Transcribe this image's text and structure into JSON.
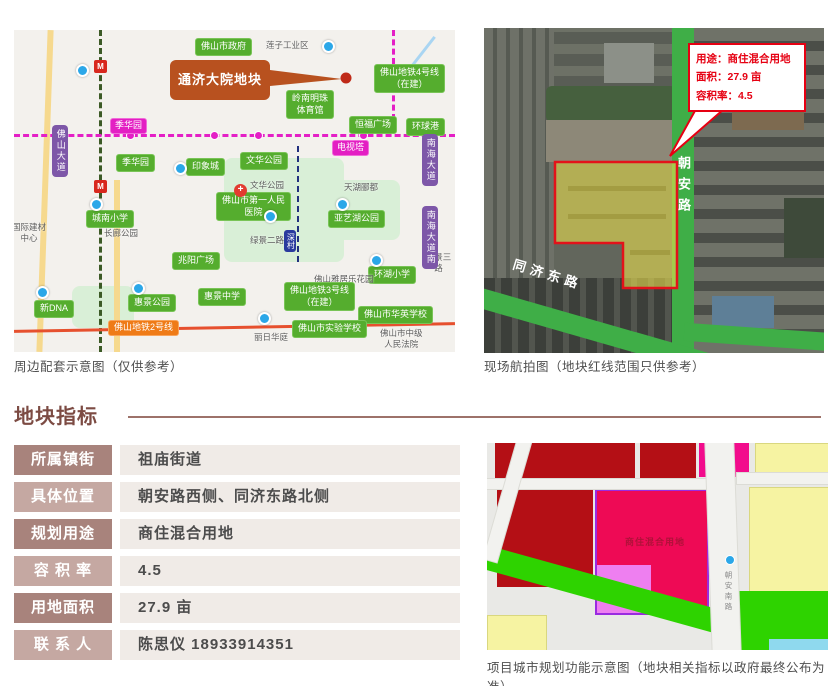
{
  "colors": {
    "section_accent": "#7c4b43",
    "table_label_dark": "#a8837c",
    "table_label_light": "#c5a8a2",
    "table_value_bg": "#f0ebe7",
    "annotation_red": "#e60012",
    "callout_orange": "#b8511f",
    "badge_green": "#55ad2e",
    "road_green": "#3fae47",
    "plan_dark_red": "#b40f15",
    "plan_crimson": "#ee0a55",
    "plan_magenta": "#f20c8c",
    "plan_yellow": "#f6f3a2",
    "plan_green": "#2ed300"
  },
  "map_panel": {
    "caption": "周边配套示意图（仅供参考）",
    "callout_label": "通济大院地块",
    "labels": [
      {
        "text": "佛山市政府",
        "type": "g",
        "x": 181,
        "y": 8
      },
      {
        "text": "莲子工业区",
        "type": "gt",
        "x": 252,
        "y": 10
      },
      {
        "text": "佛山地铁4号线\n（在建）",
        "type": "g",
        "x": 360,
        "y": 34
      },
      {
        "text": "岭南明珠\n体育馆",
        "type": "g",
        "x": 272,
        "y": 60
      },
      {
        "text": "恒福广场",
        "type": "g",
        "x": 335,
        "y": 86
      },
      {
        "text": "环球港",
        "type": "g",
        "x": 392,
        "y": 88
      },
      {
        "text": "季华园",
        "type": "m",
        "x": 96,
        "y": 88
      },
      {
        "text": "电视塔",
        "type": "m",
        "x": 318,
        "y": 110
      },
      {
        "text": "季华园",
        "type": "g",
        "x": 102,
        "y": 124
      },
      {
        "text": "印象城",
        "type": "g",
        "x": 172,
        "y": 128
      },
      {
        "text": "文华公园",
        "type": "g",
        "x": 226,
        "y": 122
      },
      {
        "text": "文华公园",
        "type": "gt",
        "x": 236,
        "y": 150
      },
      {
        "text": "天湖郦都",
        "type": "gt",
        "x": 330,
        "y": 152
      },
      {
        "text": "城南小学",
        "type": "g",
        "x": 72,
        "y": 180
      },
      {
        "text": "长廊公园",
        "type": "gt",
        "x": 90,
        "y": 198
      },
      {
        "text": "佛山市第一人民\n医院",
        "type": "g",
        "x": 202,
        "y": 162
      },
      {
        "text": "亚艺湖公园",
        "type": "g",
        "x": 314,
        "y": 180
      },
      {
        "text": "绿景二路",
        "type": "gt",
        "x": 236,
        "y": 205
      },
      {
        "text": "绿景三路",
        "type": "gt",
        "x": 408,
        "y": 222
      },
      {
        "text": "兆阳广场",
        "type": "g",
        "x": 158,
        "y": 222
      },
      {
        "text": "深村",
        "type": "bv",
        "x": 270,
        "y": 200
      },
      {
        "text": "环湖小学",
        "type": "g",
        "x": 354,
        "y": 236
      },
      {
        "text": "佛山雅居乐花园",
        "type": "gt",
        "x": 300,
        "y": 244
      },
      {
        "text": "佛山地铁3号线\n（在建）",
        "type": "g",
        "x": 270,
        "y": 252
      },
      {
        "text": "惠景中学",
        "type": "g",
        "x": 184,
        "y": 258
      },
      {
        "text": "惠景公园",
        "type": "g",
        "x": 114,
        "y": 264
      },
      {
        "text": "新DNA",
        "type": "g",
        "x": 20,
        "y": 270
      },
      {
        "text": "佛山市华英学校",
        "type": "g",
        "x": 344,
        "y": 276
      },
      {
        "text": "佛山市实验学校",
        "type": "g",
        "x": 278,
        "y": 290
      },
      {
        "text": "佛山地铁2号线",
        "type": "o",
        "x": 94,
        "y": 290
      },
      {
        "text": "丽日华庭",
        "type": "gt",
        "x": 240,
        "y": 302
      },
      {
        "text": "佛山市中级\n人民法院",
        "type": "gt",
        "x": 366,
        "y": 298
      },
      {
        "text": "国际建材\n中心",
        "type": "gt",
        "x": -2,
        "y": 192
      },
      {
        "text": "佛山大道",
        "type": "pv",
        "x": 38,
        "y": 95
      },
      {
        "text": "南海大道",
        "type": "pv",
        "x": 408,
        "y": 104
      },
      {
        "text": "南海大道南",
        "type": "pv",
        "x": 408,
        "y": 176
      },
      {
        "text": "M",
        "type": "micon",
        "x": 80,
        "y": 30
      },
      {
        "text": "M",
        "type": "micon",
        "x": 80,
        "y": 150
      },
      {
        "text": "+",
        "type": "hicon",
        "x": 220,
        "y": 154
      },
      {
        "text": "",
        "type": "marker",
        "x": 308,
        "y": 10
      },
      {
        "text": "",
        "type": "marker",
        "x": 62,
        "y": 34
      },
      {
        "text": "",
        "type": "marker",
        "x": 160,
        "y": 132
      },
      {
        "text": "",
        "type": "marker",
        "x": 250,
        "y": 180
      },
      {
        "text": "",
        "type": "marker",
        "x": 322,
        "y": 168
      },
      {
        "text": "",
        "type": "marker",
        "x": 76,
        "y": 168
      },
      {
        "text": "",
        "type": "marker",
        "x": 118,
        "y": 252
      },
      {
        "text": "",
        "type": "marker",
        "x": 356,
        "y": 224
      },
      {
        "text": "",
        "type": "marker",
        "x": 244,
        "y": 282
      },
      {
        "text": "",
        "type": "marker",
        "x": 22,
        "y": 256
      }
    ]
  },
  "aerial_panel": {
    "caption": "现场航拍图（地块红线范围只供参考）",
    "annotation": {
      "usage": "用途：商住混合用地",
      "area": "面积：27.9 亩",
      "far": "容积率：4.5"
    },
    "road_vertical": "朝安路",
    "road_diagonal": "同济东路"
  },
  "section": {
    "title": "地块指标"
  },
  "info_table": {
    "rows": [
      {
        "label": "所属镇街",
        "value": "祖庙街道"
      },
      {
        "label": "具体位置",
        "value": "朝安路西侧、同济东路北侧"
      },
      {
        "label": "规划用途",
        "value": "商住混合用地"
      },
      {
        "label": "容 积 率",
        "value": "4.5"
      },
      {
        "label": "用地面积",
        "value": "27.9 亩"
      },
      {
        "label": "联 系 人",
        "value": "陈思仪 18933914351"
      }
    ]
  },
  "planning_panel": {
    "caption": "项目城市规划功能示意图（地块相关指标以政府最终公布为准）",
    "parcel_label": "商住混合用地",
    "road_label": "朝安南路"
  }
}
